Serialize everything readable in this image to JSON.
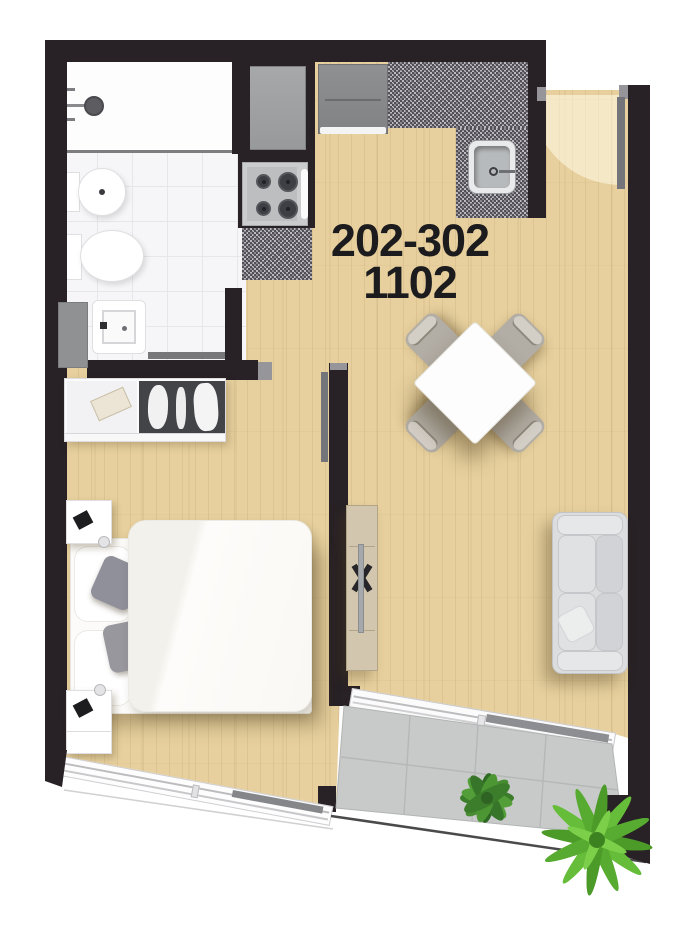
{
  "unit_label": {
    "line1": "202-302",
    "line2": "1102"
  },
  "palette": {
    "wall": "#282125",
    "wood_floor": "#e7d09e",
    "bath_tile": "#f6f6f8",
    "balcony_tile": "#c7cac9",
    "granite_counter": "#8a888d",
    "appliance_gray": "#9fa1a3",
    "closet_dark": "#434448",
    "sofa_gray": "#dcdddf",
    "plant_green": "#55a433",
    "label_text": "#1c1b1d"
  },
  "icons": [
    "shower-head-icon",
    "bidet-icon",
    "toilet-icon",
    "vanity-sink-icon",
    "towel-rail-icon",
    "fridge-icon",
    "stove-icon",
    "kitchen-sink-icon",
    "granite-counter-icon",
    "entry-door-icon",
    "interior-door-icon",
    "wardrobe-icon",
    "double-bed-icon",
    "nightstand-icon",
    "dining-table-icon",
    "dining-chair-icon",
    "sofa-icon",
    "tv-console-icon",
    "sliding-door-icon",
    "window-icon",
    "balcony-plant-icon"
  ]
}
